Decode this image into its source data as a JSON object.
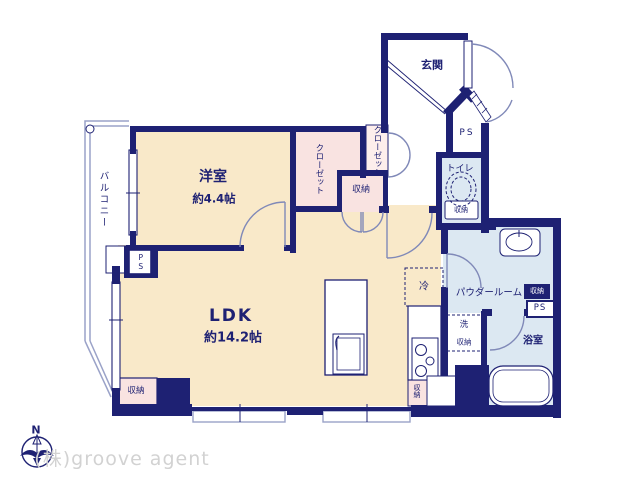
{
  "plan": {
    "western_room": {
      "name": "洋室",
      "area": "約4.4帖"
    },
    "ldk": {
      "name": "LDK",
      "area": "約14.2帖"
    },
    "entrance": {
      "label": "玄関"
    },
    "balcony": {
      "label": "バルコニー"
    },
    "closet_main": {
      "label": "クローゼット"
    },
    "closet_side": {
      "label": "クローゼット"
    },
    "storage_hall": {
      "label": "収納"
    },
    "toilet": {
      "label": "トイレ",
      "storage": "収納"
    },
    "powder_room": {
      "label": "パウダールーム",
      "storage": "収納"
    },
    "laundry": {
      "wash": "洗",
      "storage": "収納"
    },
    "bathroom": {
      "label": "浴室"
    },
    "kitchen": {
      "fridge": "冷",
      "storage": "収納"
    },
    "storage_ldk": {
      "label": "収納"
    },
    "ps_entrance": "PS",
    "ps_west": "PS",
    "ps_east": "PS"
  },
  "branding": {
    "compass_north": "N",
    "watermark": "(株)groove agent"
  },
  "colors": {
    "wall_navy": "#1e2173",
    "room_cream": "#f9e9c9",
    "closet_pink": "#f9e3e1",
    "wet_blue": "#dce8f2",
    "door_slate": "#8089b8",
    "rail_slate": "#9aa2c8",
    "watermark_gray": "#d2d2d2"
  }
}
